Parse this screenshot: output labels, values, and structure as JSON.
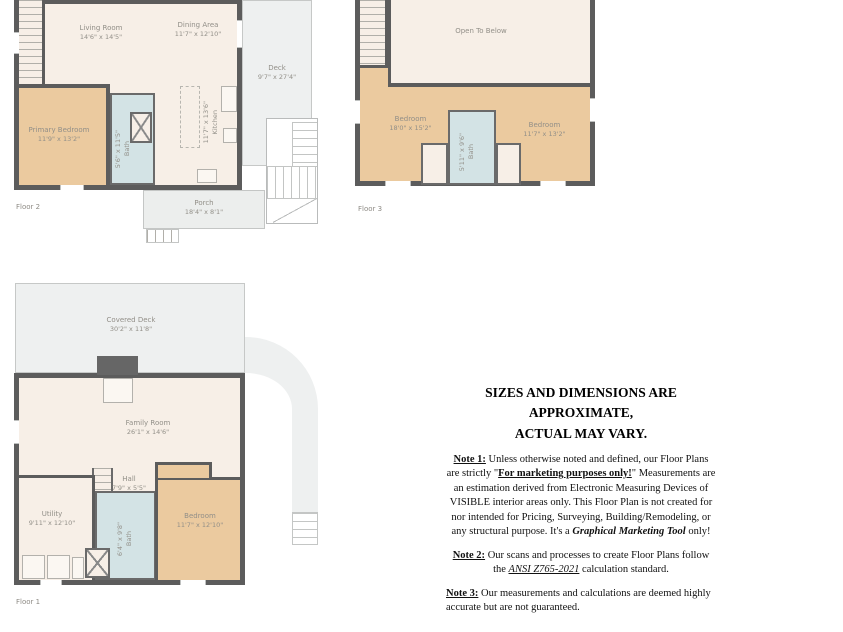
{
  "document": {
    "type": "floor-plan-marketing-sheet",
    "colors": {
      "wall": "#5c5c5c",
      "bedroom_fill": "#ebca9f",
      "interior_fill": "#f7efe7",
      "bath_fill": "#d3e3e5",
      "deck_fill": "#eef0f0",
      "plan_label_text": "#928f88",
      "disclaimer_text": "#111111"
    }
  },
  "floor2": {
    "label": "Floor 2",
    "rooms": {
      "living": {
        "name": "Living Room",
        "dims": "14'6\" x 14'5\""
      },
      "dining": {
        "name": "Dining Area",
        "dims": "11'7\" x 12'10\""
      },
      "deck": {
        "name": "Deck",
        "dims": "9'7\" x 27'4\""
      },
      "primary_bedroom": {
        "name": "Primary Bedroom",
        "dims": "11'9\" x 13'2\""
      },
      "kitchen": {
        "name": "Kitchen",
        "dims": "11'7\" x 13'6\""
      },
      "bath": {
        "name": "Bath",
        "dims": "5'6\" x 11'5\""
      },
      "porch": {
        "name": "Porch",
        "dims": "18'4\" x 8'1\""
      }
    }
  },
  "floor3": {
    "label": "Floor 3",
    "rooms": {
      "open_to_below": {
        "name": "Open To Below",
        "dims": ""
      },
      "bedroom_left": {
        "name": "Bedroom",
        "dims": "18'0\" x 15'2\""
      },
      "bedroom_right": {
        "name": "Bedroom",
        "dims": "11'7\" x 13'2\""
      },
      "bath": {
        "name": "Bath",
        "dims": "5'11\" x 9'6\""
      }
    }
  },
  "floor1": {
    "label": "Floor 1",
    "rooms": {
      "covered_deck": {
        "name": "Covered Deck",
        "dims": "30'2\" x 11'8\""
      },
      "family": {
        "name": "Family Room",
        "dims": "26'1\" x 14'6\""
      },
      "hall": {
        "name": "Hall",
        "dims": "7'9\" x 5'5\""
      },
      "utility": {
        "name": "Utility",
        "dims": "9'11\" x 12'10\""
      },
      "bedroom": {
        "name": "Bedroom",
        "dims": "11'7\" x 12'10\""
      },
      "bath": {
        "name": "Bath",
        "dims": "6'4\" x 9'8\""
      }
    }
  },
  "disclaimer": {
    "title_line1": "SIZES AND DIMENSIONS ARE APPROXIMATE,",
    "title_line2": "ACTUAL MAY VARY.",
    "note1_label": "Note 1:",
    "note1_pre": " Unless otherwise noted and defined, our Floor Plans are strictly \"",
    "note1_marketing": "For marketing purposes only!",
    "note1_mid": "\" Measurements are an estimation derived from Electronic Measuring Devices of VISIBLE interior areas only. This Floor Plan is not created for nor intended for Pricing, Surveying, Building/Remodeling, or any structural purpose. It's a ",
    "note1_tool": "Graphical Marketing Tool",
    "note1_end": " only!",
    "note2_label": "Note 2:",
    "note2_pre": " Our scans and processes to create Floor Plans follow the ",
    "note2_ansi": "ANSI Z765-2021",
    "note2_end": " calculation standard.",
    "note3_label": "Note 3:",
    "note3_text": " Our measurements and calculations are deemed highly accurate but are not guaranteed."
  }
}
